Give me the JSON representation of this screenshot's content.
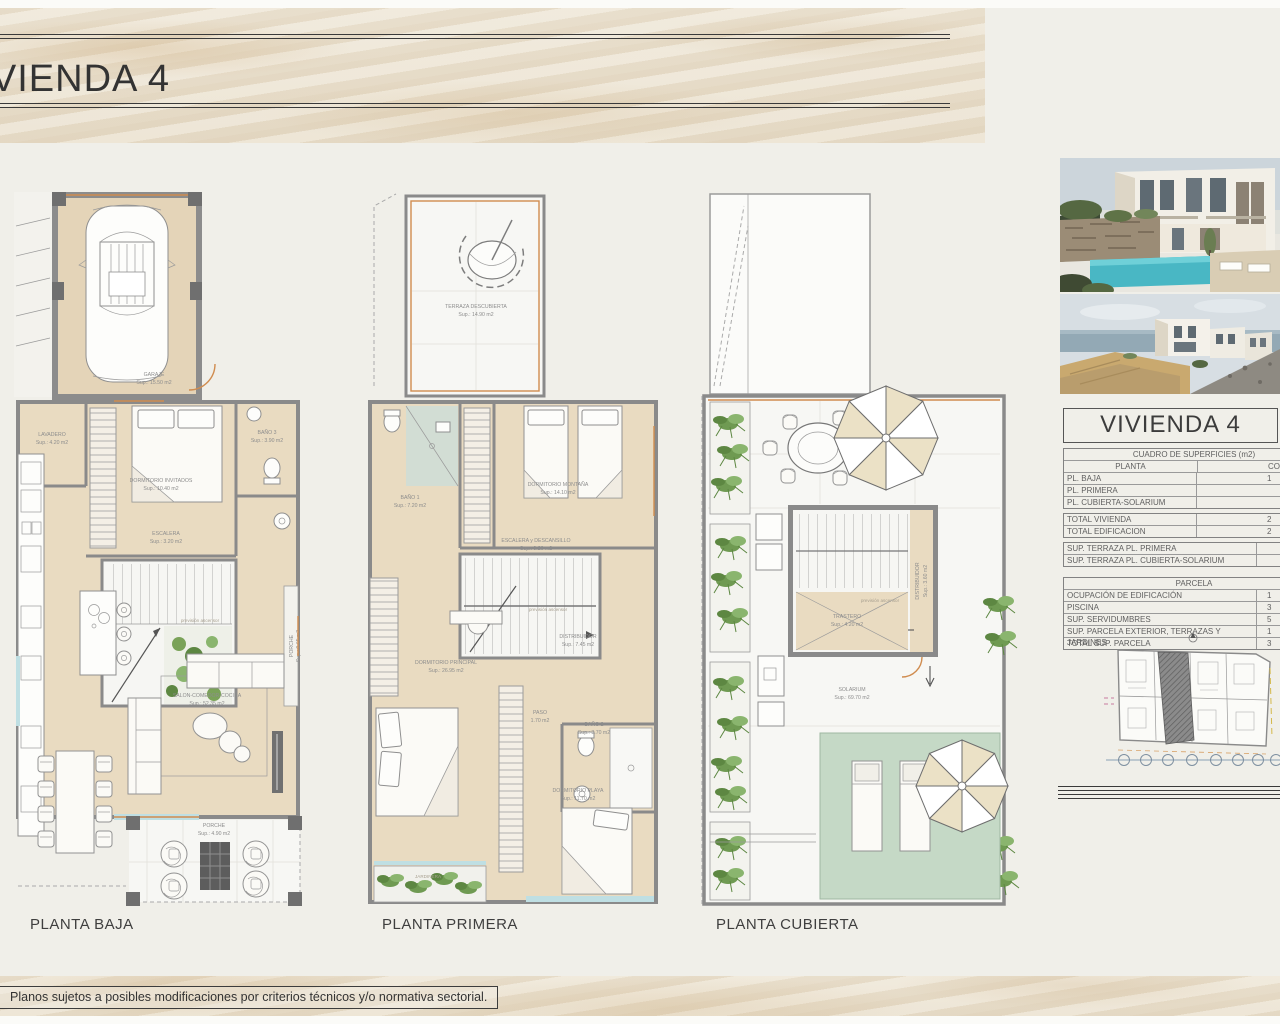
{
  "header": {
    "title": "VIVIENDA 4"
  },
  "plans": {
    "baja": {
      "label": "PLANTA BAJA",
      "rooms": {
        "garaje": {
          "name": "GARAJE",
          "area": "Sup.: 15.50 m2"
        },
        "lavadero": {
          "name": "LAVADERO",
          "area": "Sup.: 4.20 m2"
        },
        "dorm_invitados": {
          "name": "DORMITORIO INVITADOS",
          "area": "Sup.: 10.40 m2"
        },
        "bano3": {
          "name": "BAÑO 3",
          "area": "Sup.: 3.90 m2"
        },
        "escalera": {
          "name": "ESCALERA",
          "area": "Sup.: 3.20 m2"
        },
        "porche_lateral": {
          "name": "PORCHE",
          "area": "Sup.: 0.65 m2"
        },
        "salon": {
          "name": "SALON-COMEDOR-COCINA",
          "area": "Sup.: 52.35 m2"
        },
        "porche": {
          "name": "PORCHE",
          "area": "Sup.: 4.90 m2"
        },
        "ascensor": "previsión ascensor"
      }
    },
    "primera": {
      "label": "PLANTA PRIMERA",
      "rooms": {
        "terraza": {
          "name": "TERRAZA DESCUBIERTA",
          "area": "Sup.: 14.90 m2"
        },
        "bano1": {
          "name": "BAÑO 1",
          "area": "Sup.: 7.20 m2"
        },
        "dorm_montana": {
          "name": "DORMITORIO MONTAÑA",
          "area": "Sup.: 14.10 m2"
        },
        "escalera": {
          "name": "ESCALERA y DESCANSILLO",
          "area": "Sup.: 9.20 m2"
        },
        "distribuidor": {
          "name": "DISTRIBUIDOR",
          "area": "Sup.: 7.45 m2"
        },
        "dorm_principal": {
          "name": "DORMITORIO PRINCIPAL",
          "area": "Sup.: 26.95 m2"
        },
        "paso": {
          "name": "PASO",
          "area": "1.70 m2"
        },
        "bano2": {
          "name": "BAÑO 2",
          "area": "Sup.: 3.70 m2"
        },
        "dorm_playa": {
          "name": "DORMITORIO PLAYA",
          "area": "Sup.: 11.70 m2"
        },
        "jardinera": "JARDINERA",
        "ascensor": "previsión ascensor"
      }
    },
    "cubierta": {
      "label": "PLANTA CUBIERTA",
      "rooms": {
        "distribuidor": {
          "name": "DISTRIBUIDOR",
          "area": "Sup.: 3.60 m2"
        },
        "trastero": {
          "name": "TRASTERO",
          "area": "Sup.: 4.20 m2"
        },
        "solarium": {
          "name": "SOLARIUM",
          "area": "Sup.: 69.70 m2"
        },
        "ascensor": "previsión ascensor"
      }
    }
  },
  "summary": {
    "title": "VIVIENDA 4",
    "table_header": "CUADRO DE SUPERFICIES (m2)",
    "col_planta": "PLANTA",
    "col_construida": "CONSTRUIDA",
    "parcela_header": "PARCELA",
    "rows": [
      {
        "label": "PL. BAJA",
        "value": "1"
      },
      {
        "label": "PL. PRIMERA",
        "value": ""
      },
      {
        "label": "PL. CUBIERTA-SOLARIUM",
        "value": ""
      },
      {
        "label": "TOTAL VIVIENDA",
        "value": "2"
      },
      {
        "label": "TOTAL EDIFICACION",
        "value": "2"
      },
      {
        "label": "SUP. TERRAZA PL. PRIMERA",
        "value": ""
      },
      {
        "label": "SUP. TERRAZA PL. CUBIERTA-SOLARIUM",
        "value": ""
      },
      {
        "label": "OCUPACIÓN DE EDIFICACIÓN",
        "value": "1"
      },
      {
        "label": "PISCINA",
        "value": "3"
      },
      {
        "label": "SUP. SERVIDUMBRES",
        "value": "5"
      },
      {
        "label": "SUP. PARCELA EXTERIOR, TERRAZAS Y JARDINES",
        "value": "1"
      },
      {
        "label": "TOTAL SUP. PARCELA",
        "value": "3"
      }
    ]
  },
  "footer": {
    "disclaimer": "Planos sujetos a posibles modificaciones por criterios técnicos y/o normativa sectorial."
  }
}
